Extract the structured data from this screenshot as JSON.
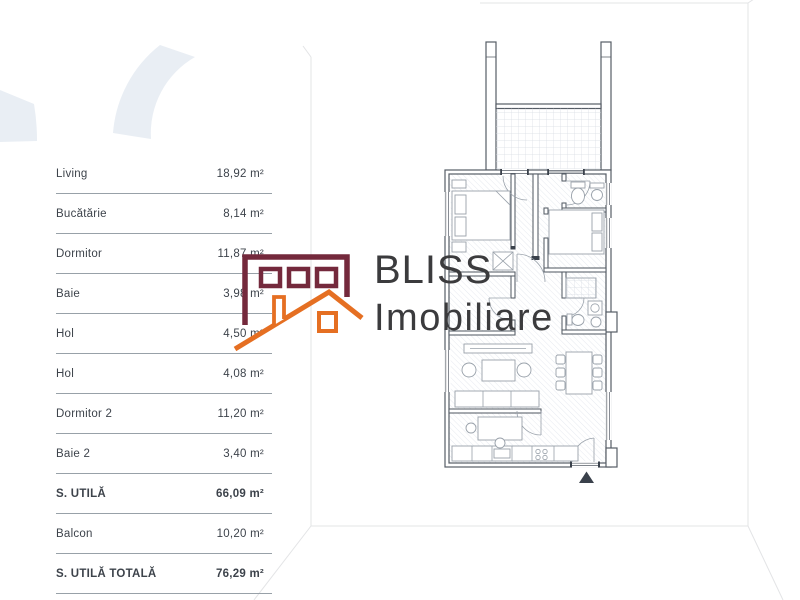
{
  "logo": {
    "brand_name": "BLISS",
    "brand_type": "Imobiliare"
  },
  "area_table": {
    "rows": [
      {
        "label": "Living",
        "value": "18,92 m²",
        "bold": false
      },
      {
        "label": "Bucătărie",
        "value": "8,14 m²",
        "bold": false
      },
      {
        "label": "Dormitor",
        "value": "11,87 m²",
        "bold": false
      },
      {
        "label": "Baie",
        "value": "3,98 m²",
        "bold": false
      },
      {
        "label": "Hol",
        "value": "4,50 m²",
        "bold": false
      },
      {
        "label": "Hol",
        "value": "4,08 m²",
        "bold": false
      },
      {
        "label": "Dormitor 2",
        "value": "11,20 m²",
        "bold": false
      },
      {
        "label": "Baie 2",
        "value": "3,40 m²",
        "bold": false
      },
      {
        "label": "S. UTILĂ",
        "value": "66,09 m²",
        "bold": true
      },
      {
        "label": "Balcon",
        "value": "10,20 m²",
        "bold": false
      },
      {
        "label": "S. UTILĂ TOTALĂ",
        "value": "76,29 m²",
        "bold": true
      }
    ]
  },
  "floor_plan": {
    "entrance_marker": "triangle-up"
  },
  "colors": {
    "text": "#3d434b",
    "divider": "#98a1a8",
    "wall": "#565d66",
    "furniture": "#99a1aa",
    "dark": "#3a414b",
    "frame": "#e3e4e6",
    "arc_fill": "#e9eef4",
    "logo_text": "#3b3b3d",
    "house": "#74293c",
    "roof": "#e56f22"
  }
}
